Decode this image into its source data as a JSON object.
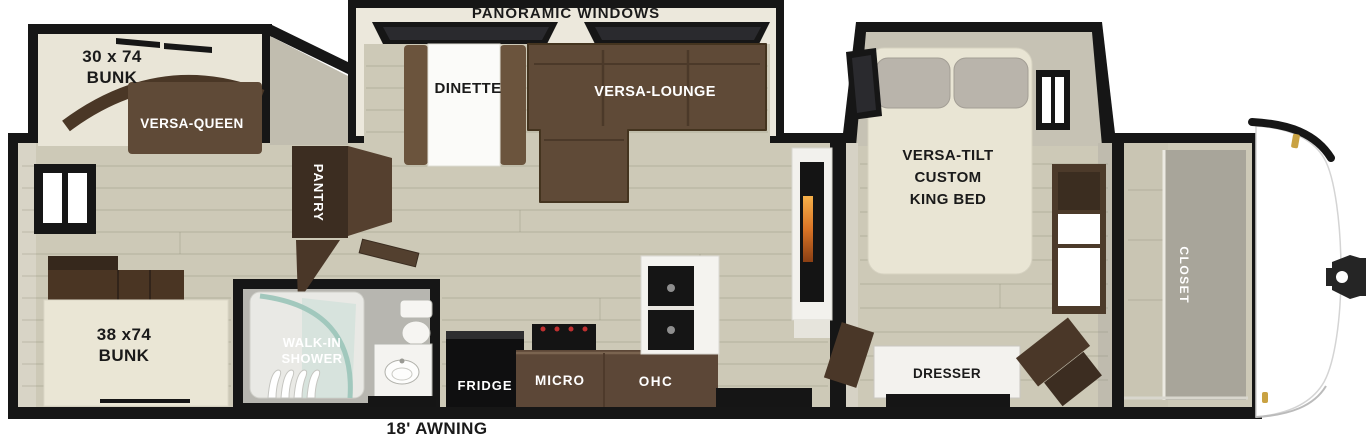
{
  "plan": {
    "top_label": "PANORAMIC WINDOWS",
    "awning_label": "18' AWNING",
    "areas": {
      "bunk_over": {
        "line1": "30 x 74",
        "line2": "BUNK"
      },
      "versa_queen": {
        "label": "VERSA-QUEEN"
      },
      "bunk_lower": {
        "line1": "38 x74",
        "line2": "BUNK"
      },
      "pantry": {
        "label": "PANTRY"
      },
      "dinette": {
        "label": "DINETTE"
      },
      "versa_lounge": {
        "label": "VERSA-LOUNGE"
      },
      "shower": {
        "line1": "WALK-IN",
        "line2": "SHOWER"
      },
      "kitchen": {
        "fridge": "FRIDGE",
        "micro": "MICRO",
        "ohc": "OHC"
      },
      "bedroom": {
        "line1": "VERSA-TILT",
        "line2": "CUSTOM",
        "line3": "KING BED",
        "dresser": "DRESSER"
      },
      "closet": {
        "label": "CLOSET"
      }
    }
  },
  "colors": {
    "wall_black": "#161616",
    "floor_wood": "#cdc9b7",
    "wall_beige": "#d8d4c6",
    "wall_gray": "#bfbbae",
    "slide_cream": "#e9e5d7",
    "furniture_brown": "#5f4a37",
    "cabinet_dark": "#3c2d21",
    "counter_brown": "#5c4737",
    "bed_cream": "#e9e5d4",
    "mattress_cream": "#eae6d5",
    "pillow_gray": "#b9b4ab",
    "glass_teal": "#9ec6bb",
    "accent_gold": "#c9a242",
    "label_black": "#1a1a1a",
    "label_white": "#ffffff"
  }
}
